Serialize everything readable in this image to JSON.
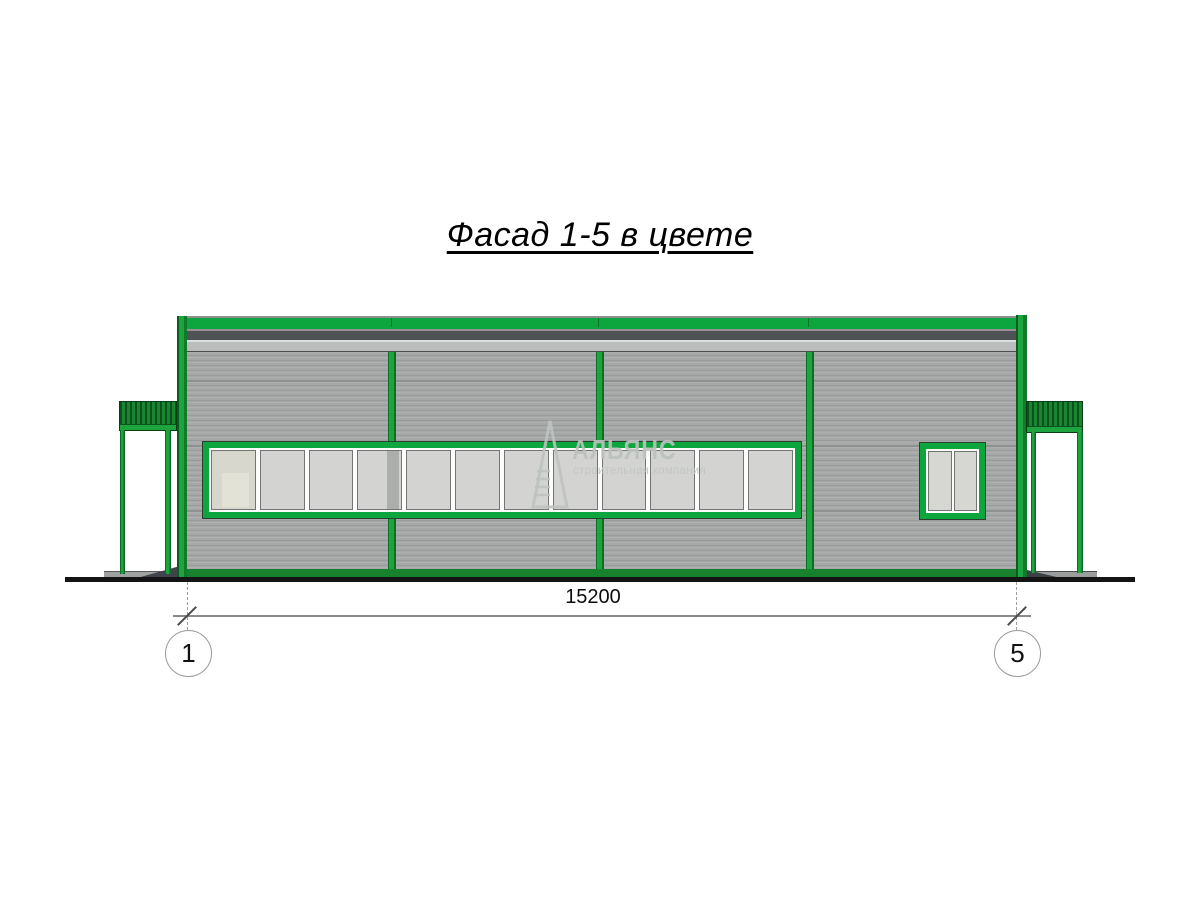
{
  "drawing": {
    "title": "Фасад 1-5 в цвете",
    "dimension_label": "15200",
    "axis_left": "1",
    "axis_right": "5"
  },
  "watermark": {
    "name": "АЛЬЯНС",
    "subtitle": "строительная компания"
  },
  "facade": {
    "pane_count": 12,
    "tinted_pane_index": 0,
    "shadow_pane_index": 3,
    "colors": {
      "frame_green": "#0ca53e",
      "dark_green": "#0d5a20",
      "wall_gray": "#a6a8a7",
      "fascia_dark": "#4e5254",
      "fascia_light": "#bbbdbc",
      "glass": "#d3d4d1"
    }
  }
}
